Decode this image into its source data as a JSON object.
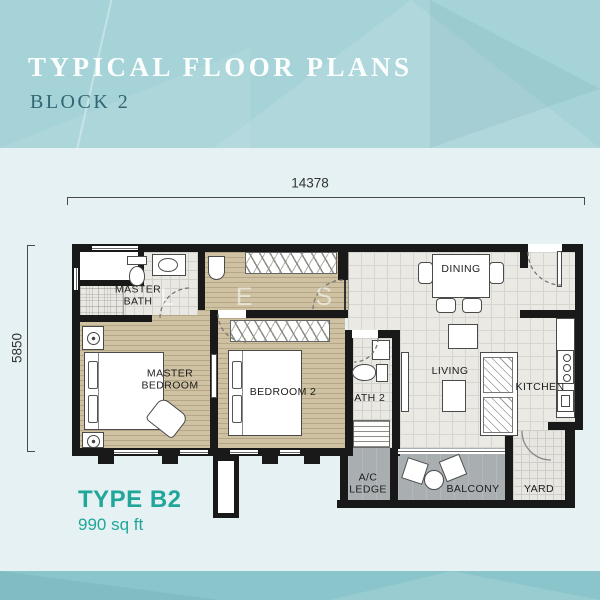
{
  "header": {
    "title": "TYPICAL FLOOR PLANS",
    "subtitle": "BLOCK 2"
  },
  "dimensions": {
    "width": "14378",
    "depth": "5850"
  },
  "floor_plan": {
    "rooms": {
      "master_bath": "MASTER BATH",
      "master_bedroom": "MASTER BEDROOM",
      "bedroom_2": "BEDROOM 2",
      "bath_2": "BATH 2",
      "dining": "DINING",
      "living": "LIVING",
      "kitchen": "KITCHEN",
      "ac_ledge": "A/C LEDGE",
      "balcony": "BALCONY",
      "yard": "YARD"
    },
    "watermark": "L E S"
  },
  "unit": {
    "type": "TYPE B2",
    "area": "990 sq ft"
  },
  "colors": {
    "accent": "#21a69a",
    "header_bg": "#a6d3d8",
    "footer_bg": "#8ac5cb",
    "page_bg": "#e5f1f3",
    "wall": "#191919",
    "wood_floor": "#cfc2a3",
    "tile_floor": "#ebe9e4",
    "bath_floor": "#e9e8e2",
    "outdoor_floor": "#a9aeb1",
    "dim_line": "#4a4a4a",
    "subtitle_color": "#2f6672"
  }
}
